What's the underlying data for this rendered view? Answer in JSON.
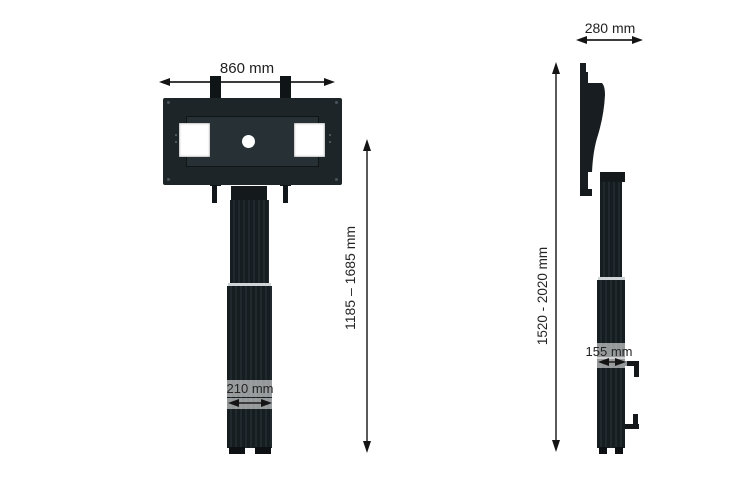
{
  "drawing": {
    "type": "technical-dimension-drawing",
    "subject": "motorised TV floor stand, front and side elevation",
    "front_view": {
      "width_label": "860 mm",
      "height_range_label": "1185 – 1685 mm",
      "column_width_label": "210 mm"
    },
    "side_view": {
      "depth_label": "280 mm",
      "height_range_label": "1520 - 2020 mm",
      "column_depth_label": "155 mm"
    },
    "colors": {
      "structure": "#1d2529",
      "dimension_line": "#3c3c3c",
      "text": "#242424",
      "background": "#ffffff"
    }
  }
}
